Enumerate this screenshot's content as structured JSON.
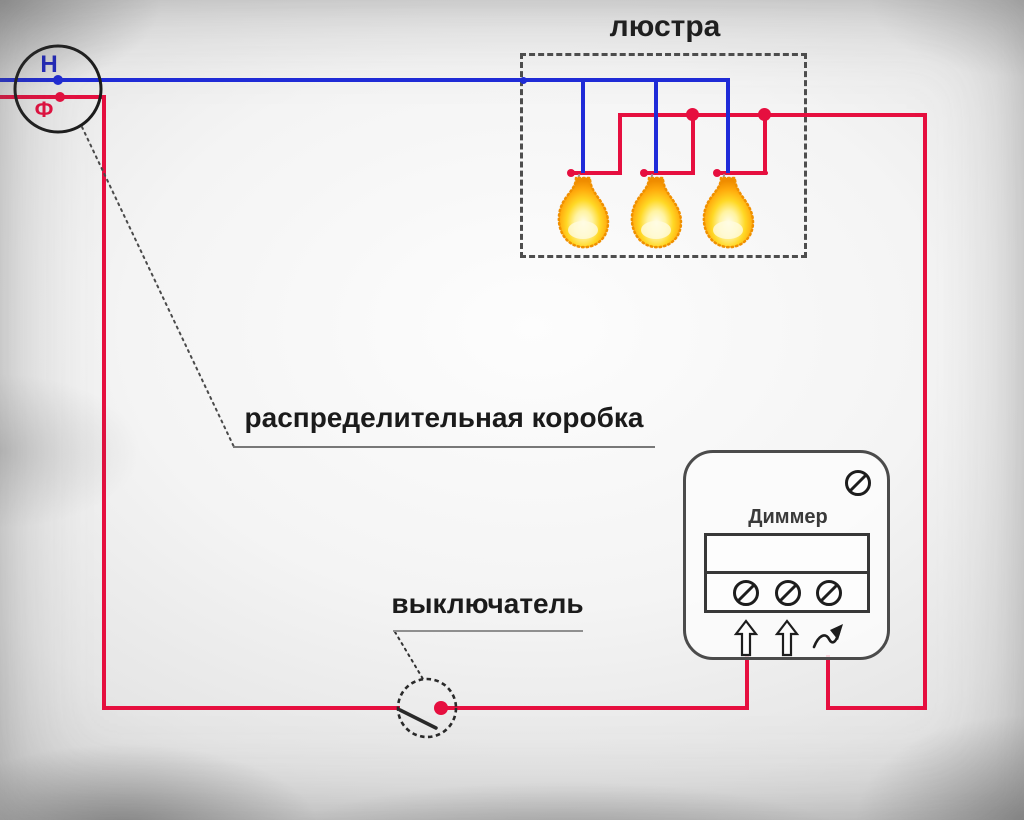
{
  "colors": {
    "neutral": "#1f2bd9",
    "phase": "#e60f3f",
    "line": "#262626",
    "leader": "#555555",
    "bulb_glow": "#ffd825",
    "bulb_edge": "#ef8c00"
  },
  "labels": {
    "chandelier": "люстра",
    "distribution_box": "распределительная коробка",
    "switch": "выключатель",
    "dimmer": "Диммер",
    "neutral": "Н",
    "phase": "Ф"
  },
  "chandelier": {
    "bulb_count": 3
  },
  "dimmer": {
    "terminal_screw_count": 3,
    "mounting_screw_count": 1,
    "load_arrow_count": 2
  },
  "icons": {
    "terminal_screw": "slashed-circle ⊘",
    "load_arrow": "hollow up arrow ⇧",
    "dimmer_adjust": "wavy arrow ⤳"
  }
}
